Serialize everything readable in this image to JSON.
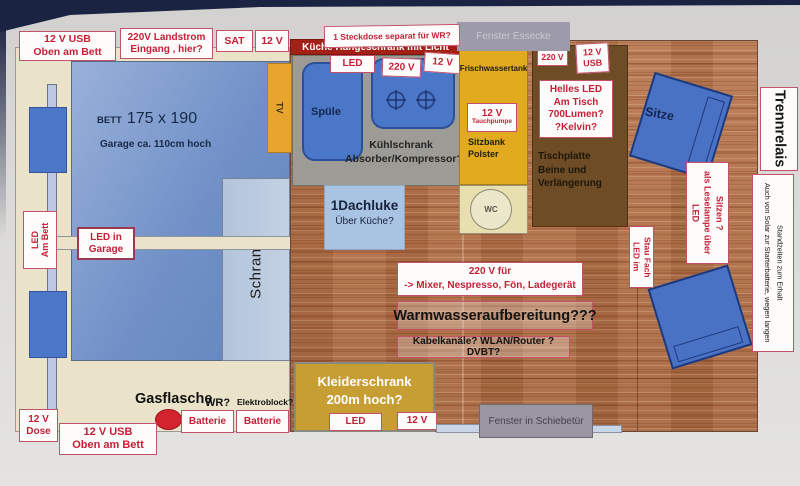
{
  "top": {
    "usb_top": "12 V USB\nOben am Bett",
    "landstrom": "220V Landstrom\nEingang , hier?",
    "sat": "SAT",
    "v12": "12 V",
    "steckdose_wr": "1 Steckdose separat für WR?"
  },
  "bedroom": {
    "bett": "BETT",
    "size": "175 x 190",
    "garage": "Garage ca. 110cm hoch",
    "led_am_bett": "LED\nAm Bett",
    "led_garage": "LED in\nGarage",
    "schrank": "Schrank",
    "tv": "TV",
    "gasflasche": "Gasflasche",
    "wr": "WR?",
    "elektroblock": "Elektroblock?",
    "batterie_1": "Batterie",
    "batterie_2": "Batterie",
    "dose": "12 V\nDose",
    "usb_bottom": "12 V USB\nOben am Bett"
  },
  "kitchen": {
    "haengeschrank": "Küche Hängeschrank mit Licht",
    "led": "LED",
    "v220": "220 V",
    "v12": "12 V",
    "spuele": "Spüle",
    "kuehlschrank": "Kühlschrank\nAbsorber/Kompressor?",
    "dachluke_title": "1Dachluke",
    "dachluke_sub": "Über Küche?"
  },
  "water": {
    "tank": "Frischwassertank",
    "pump_v": "12 V",
    "pump": "Tauchpumpe",
    "sitzbank": "Sitzbank\nPolster",
    "wc": "WC"
  },
  "dinette": {
    "fenster_essecke": "Fenster Essecke",
    "v220": "220 V",
    "v12usb": "12 V\nUSB",
    "helles_led": "Helles LED\nAm Tisch\n700Lumen?\n?Kelvin?",
    "tischplatte": "Tischplatte\nBeine und\nVerlängerung",
    "sitze": "Sitze"
  },
  "center": {
    "v220_fuer": "220 V für\n-> Mixer, Nespresso, Fön, Ladegerät",
    "warmwasser": "Warmwasseraufbereitung???",
    "kabel": "Kabelkanäle? WLAN/Router ? DVBT?"
  },
  "wardrobe": {
    "title": "Kleiderschrank\n200m hoch?",
    "led": "LED",
    "v12": "12 V"
  },
  "door": {
    "fenster_schiebetuer": "Fenster in Schiebetür"
  },
  "right": {
    "led_stau": "LED im\nStau Fach",
    "leselampe": "LED\nals Leselampe über\nSitzen ?",
    "trennrelais": "Trennrelais",
    "solar": "Auch von Solar zur Starterbatterie, wegen langen\nStandzeiten zum Erhalt"
  },
  "colors": {
    "accent_red_border": "#c4506a",
    "text_red": "#c52038",
    "dark_red_bar": "#a32017",
    "bed_blue": "#7d9cd0",
    "window_blue": "#4a77c8",
    "seat_blue": "#4a72c4",
    "cream": "#ebe3c9",
    "kitchen_gray": "#9c9b96",
    "tank_yellow": "#e2aa1f",
    "wc_beige": "#e7dfae",
    "table_brown": "#6e4d26",
    "wood": "#b5744a",
    "wardrobe_gold": "#c79e33",
    "window_gray": "#9b99a6",
    "photo_navy": "#1b2342",
    "paper": "#dbdad8"
  }
}
